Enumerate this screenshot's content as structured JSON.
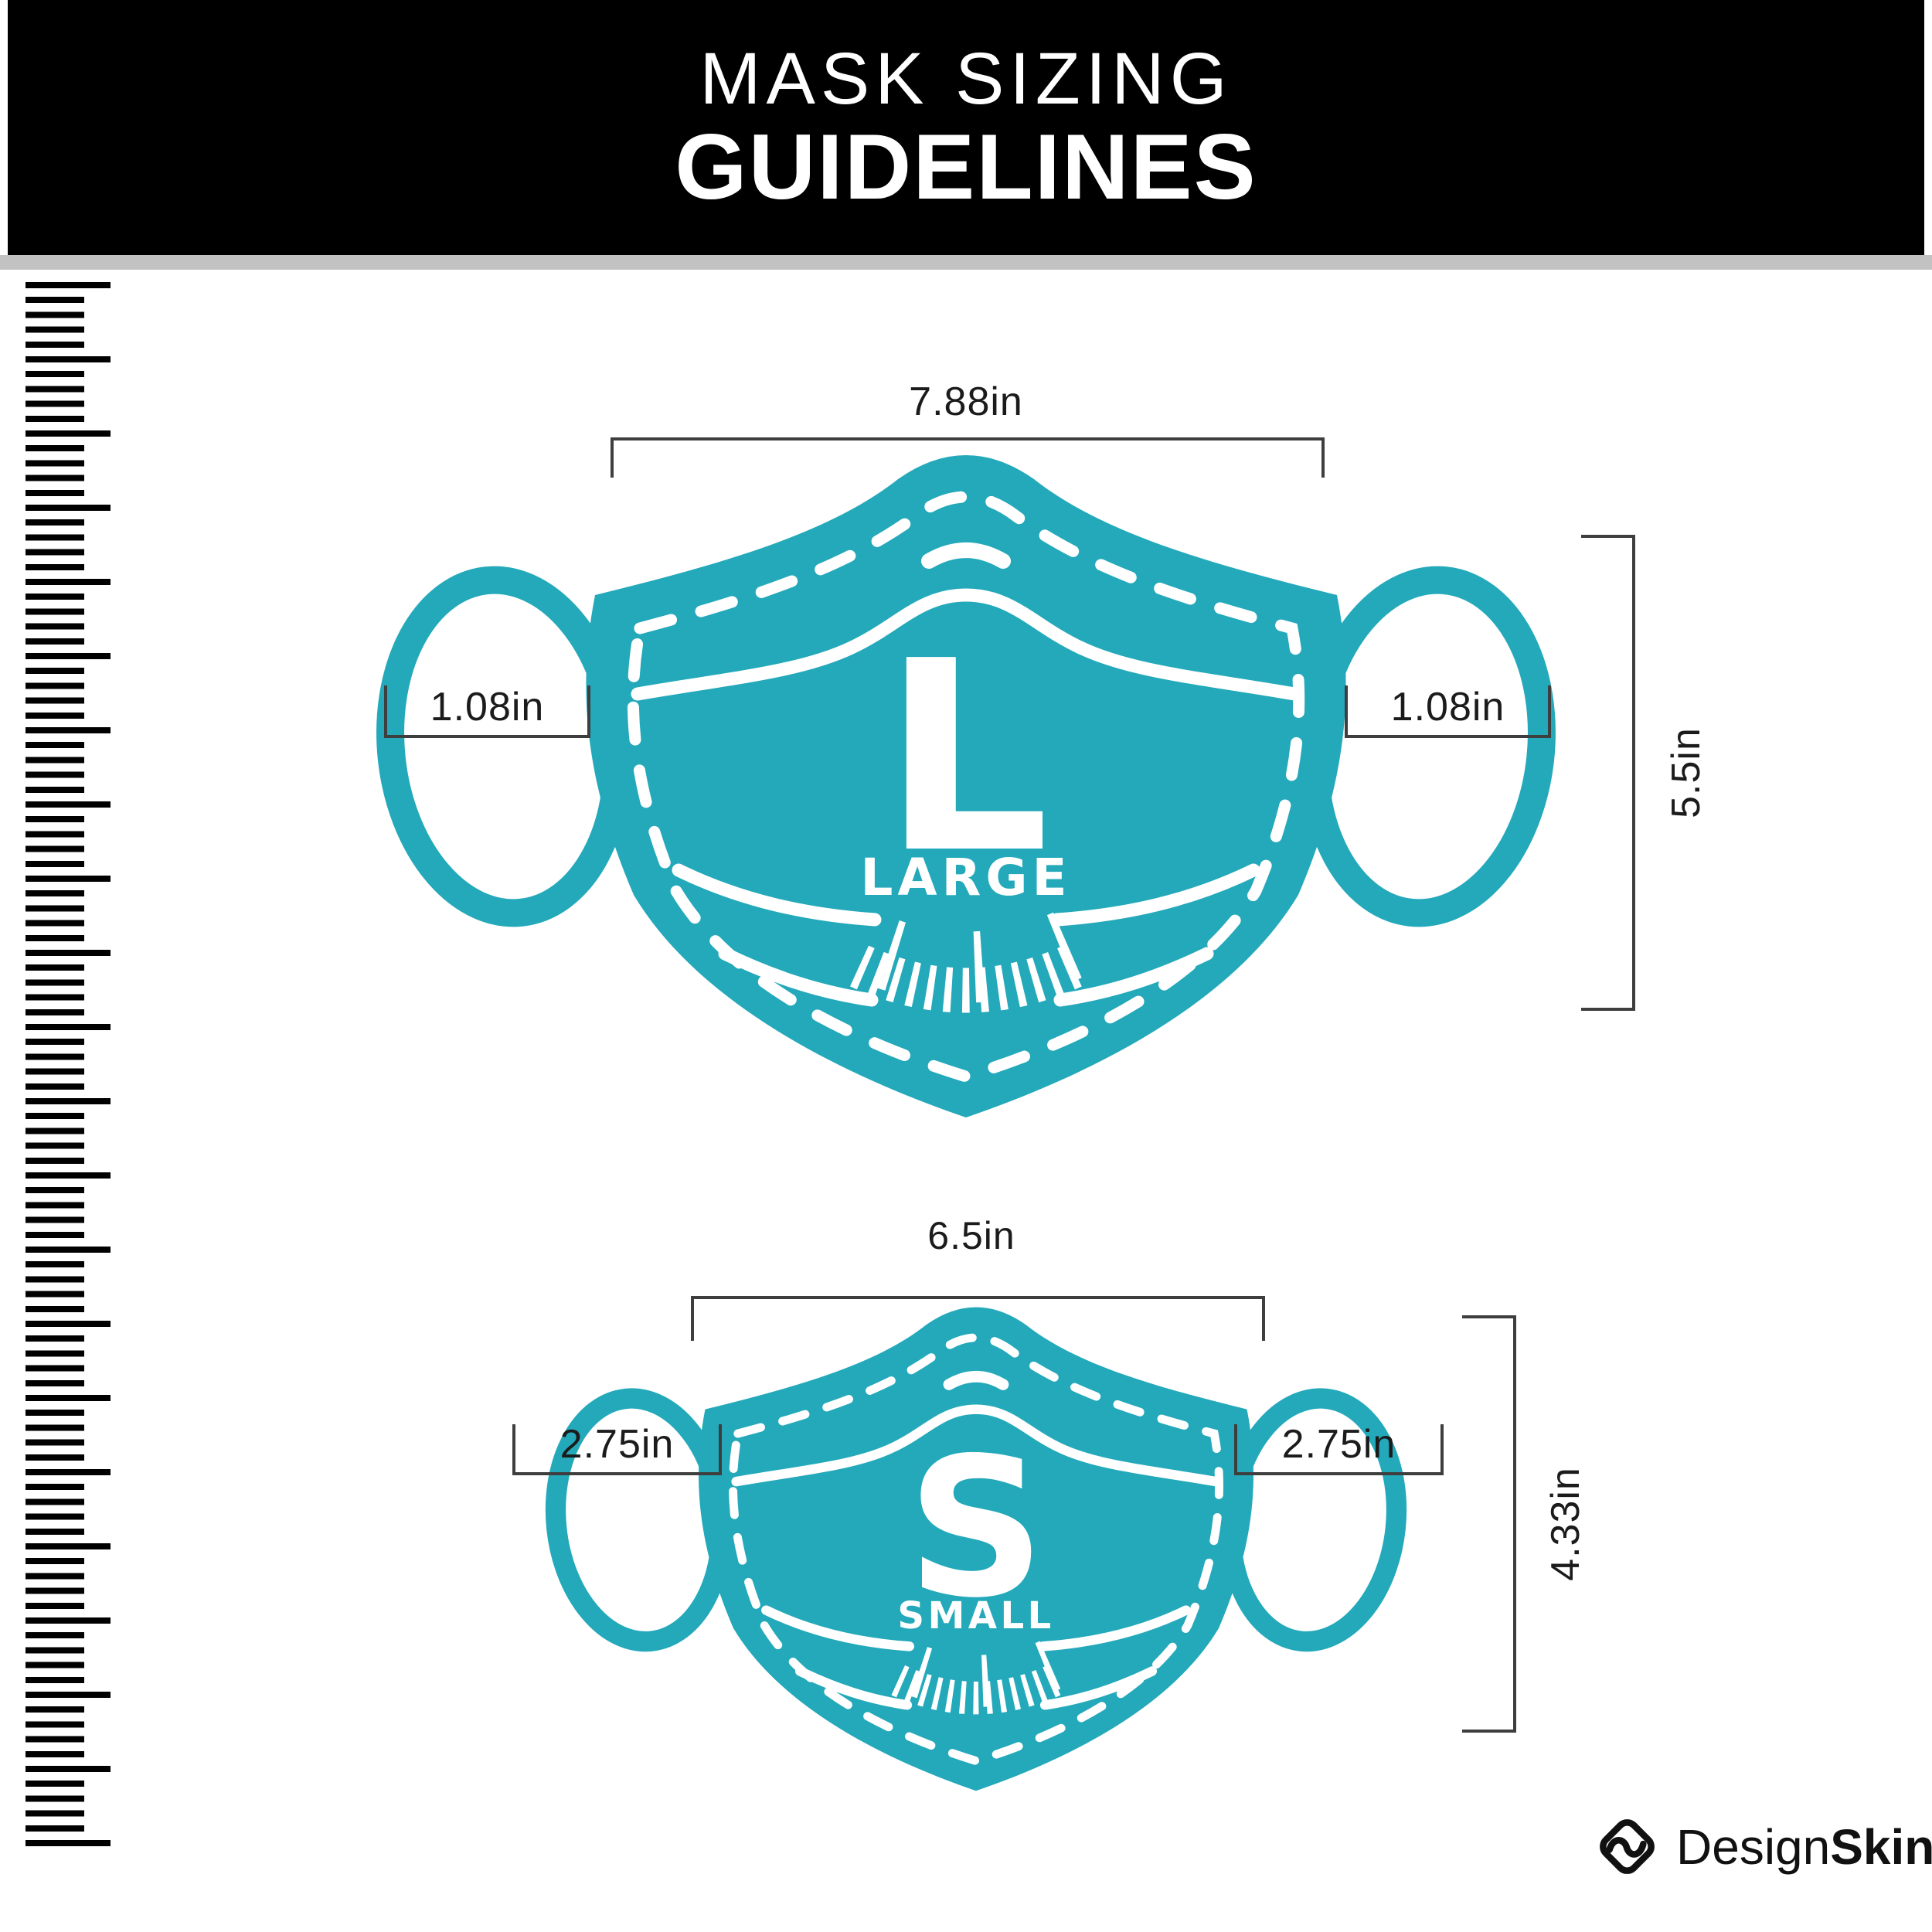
{
  "header": {
    "title_line1": "MASK SIZING",
    "title_line2": "GUIDELINES"
  },
  "masks": {
    "large": {
      "letter": "L",
      "size_name": "LARGE",
      "width_label": "7.88in",
      "ear_left_label": "1.08in",
      "ear_right_label": "1.08in",
      "height_label": "5.5in"
    },
    "small": {
      "letter": "S",
      "size_name": "SMALL",
      "width_label": "6.5in",
      "ear_left_label": "2.75in",
      "ear_right_label": "2.75in",
      "height_label": "4.33in"
    }
  },
  "footer": {
    "brand_regular": "Design",
    "brand_bold": "Skinz"
  },
  "colors": {
    "mask-teal": "#23A9BA",
    "header-bg": "#000000",
    "divider-gray": "#C2C2C2",
    "dim-line": "#3E3E3E",
    "label-text": "#1B1B1B",
    "tick-black": "#000000"
  },
  "icons": {
    "brand-logo": "diamond-s-logo",
    "left-ruler": "vertical-ruler-ticks",
    "mask-chin-ruler": "curved-ruler-ticks"
  }
}
